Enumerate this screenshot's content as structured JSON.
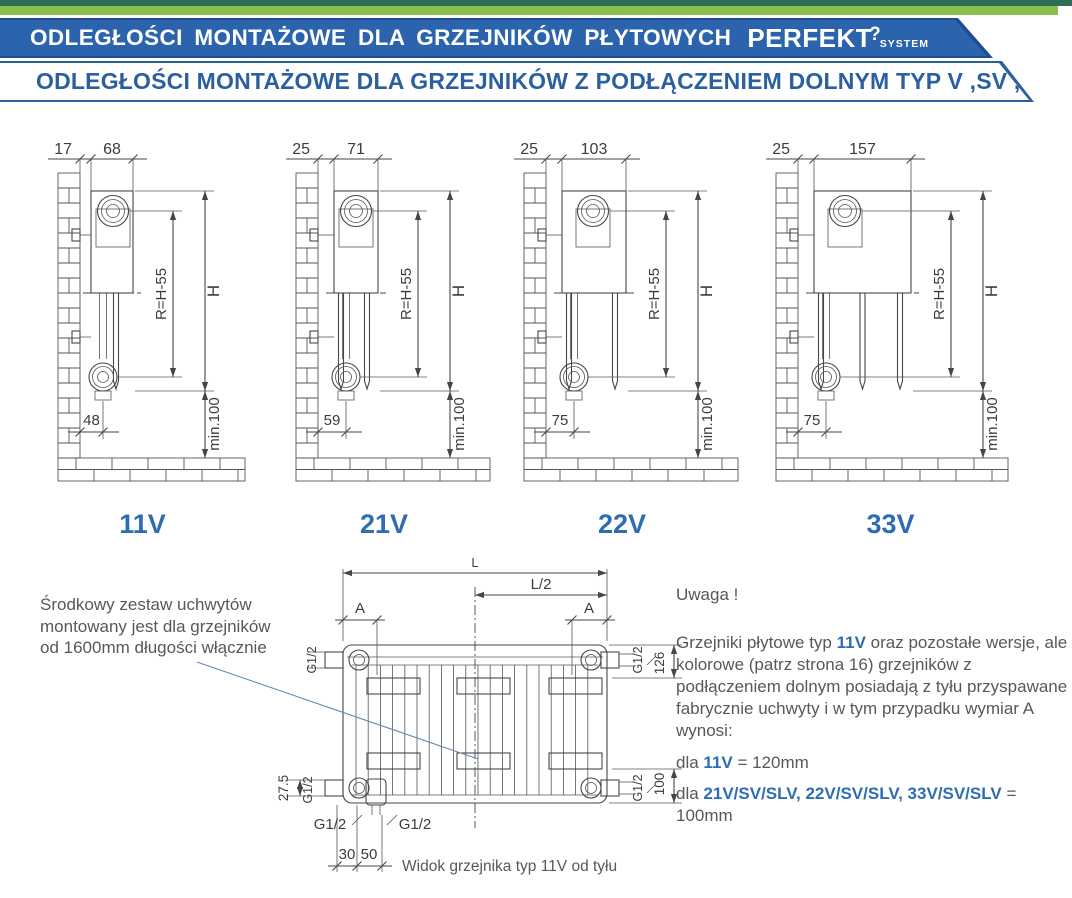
{
  "header": {
    "banner_title": "ODLEGŁOŚCI MONTAŻOWE DLA GRZEJNIKÓW PŁYTOWYCH",
    "brand": "PERFEKT",
    "brand_hook": "?",
    "brand_sub": "SYSTEM",
    "subtitle": "ODLEGŁOŚCI MONTAŻOWE DLA GRZEJNIKÓW Z PODŁĄCZENIEM DOLNYM TYP V ,SV ,SLV"
  },
  "colors": {
    "strip_dark": "#2d6e57",
    "strip_green": "#8cbf4e",
    "banner_edge": "#1d4d8f",
    "banner_blue": "#2b64ad",
    "subtitle_blue": "#2b5f9e",
    "accent_blue": "#2e6db4",
    "text_gray": "#58585a",
    "line_gray": "#46464a"
  },
  "side_diagrams": [
    {
      "type_label": "11V",
      "wall_gap_mm": "17",
      "depth_mm": "68",
      "radius_label": "R=H-55",
      "height_label": "H",
      "bottom_offset_mm": "48",
      "floor_min_label": "min.100",
      "panels": 1
    },
    {
      "type_label": "21V",
      "wall_gap_mm": "25",
      "depth_mm": "71",
      "radius_label": "R=H-55",
      "height_label": "H",
      "bottom_offset_mm": "59",
      "floor_min_label": "min.100",
      "panels": 2
    },
    {
      "type_label": "22V",
      "wall_gap_mm": "25",
      "depth_mm": "103",
      "radius_label": "R=H-55",
      "height_label": "H",
      "bottom_offset_mm": "75",
      "floor_min_label": "min.100",
      "panels": 2
    },
    {
      "type_label": "33V",
      "wall_gap_mm": "25",
      "depth_mm": "157",
      "radius_label": "R=H-55",
      "height_label": "H",
      "bottom_offset_mm": "75",
      "floor_min_label": "min.100",
      "panels": 3
    }
  ],
  "rear_diagram": {
    "length_label": "L",
    "half_length_label": "L/2",
    "bracket_dim_label": "A",
    "thread_label": "G1/2",
    "top_connection_offset": "126",
    "bottom_connection_offset": "100",
    "drain_offset": "27.5",
    "dim_30": "30",
    "dim_50": "50",
    "caption_prefix": "Widok grzejnika typ ",
    "caption_type": "11V",
    "caption_suffix": " od tyłu"
  },
  "notes": {
    "left_note_lines": [
      "Środkowy zestaw uchwytów",
      "montowany jest dla grzejników",
      "od 1600mm długości włącznie"
    ],
    "warning_title": "Uwaga !",
    "paragraph_before": "Grzejniki płytowe typ ",
    "paragraph_highlight": "11V",
    "paragraph_after": " oraz pozostałe wersje, ale kolorowe (patrz strona 16) grzejników z podłączeniem dolnym posiadają z tyłu przyspawane fabrycznie uchwyty i w tym przypadku wymiar A wynosi:",
    "rule1_prefix": "dla ",
    "rule1_types": "11V",
    "rule1_value": " = 120mm",
    "rule2_prefix": "dla ",
    "rule2_types": "21V/SV/SLV, 22V/SV/SLV, 33V/SV/SLV",
    "rule2_value": " = 100mm"
  }
}
